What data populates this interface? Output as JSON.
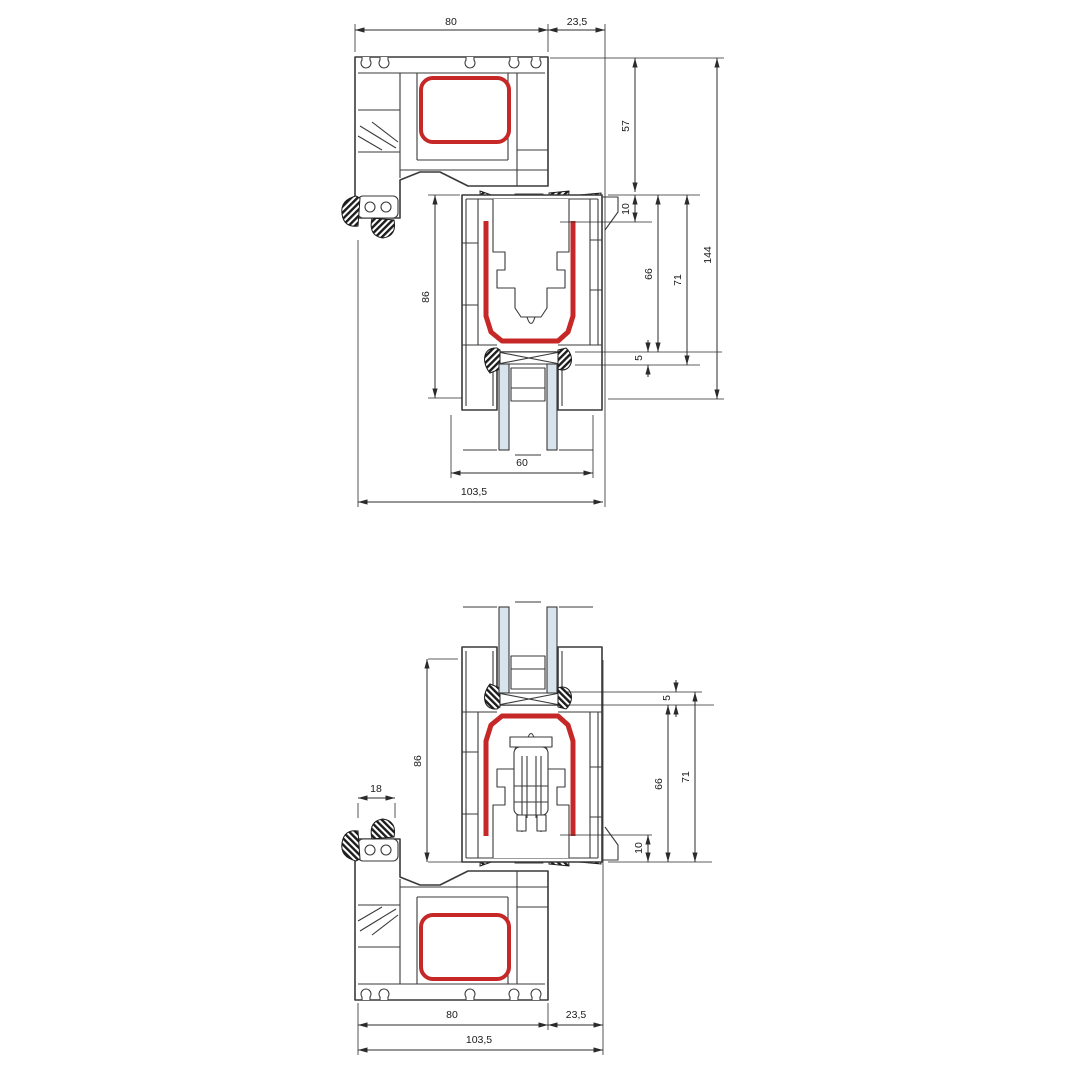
{
  "document": {
    "type": "technical-drawing",
    "subject": "PVC window frame and sash cross-sections (top and bottom detail)",
    "background": "#ffffff"
  },
  "colors": {
    "line": "#3a3a3a",
    "dim_line": "#2b2b2b",
    "accent_red": "#c62828",
    "glass_blue": "#d8e4ec",
    "seal_black": "#1c1c1c",
    "background": "#ffffff"
  },
  "top_section": {
    "dimensions": {
      "frame_depth": "80",
      "sash_overhang": "23,5",
      "frame_face": "57",
      "seal_overlap": "10",
      "rebate_depth": "66",
      "rebate_full": "71",
      "overall_height": "144",
      "sash_depth": "86",
      "glazing_block": "5",
      "glazing_width": "60",
      "overall_depth": "103,5"
    }
  },
  "bottom_section": {
    "dimensions": {
      "bead_width": "18",
      "sash_depth": "86",
      "glazing_block": "5",
      "rebate_depth": "66",
      "rebate_full": "71",
      "seal_overlap": "10",
      "frame_depth": "80",
      "sash_overhang": "23,5",
      "overall_depth": "103,5"
    }
  }
}
